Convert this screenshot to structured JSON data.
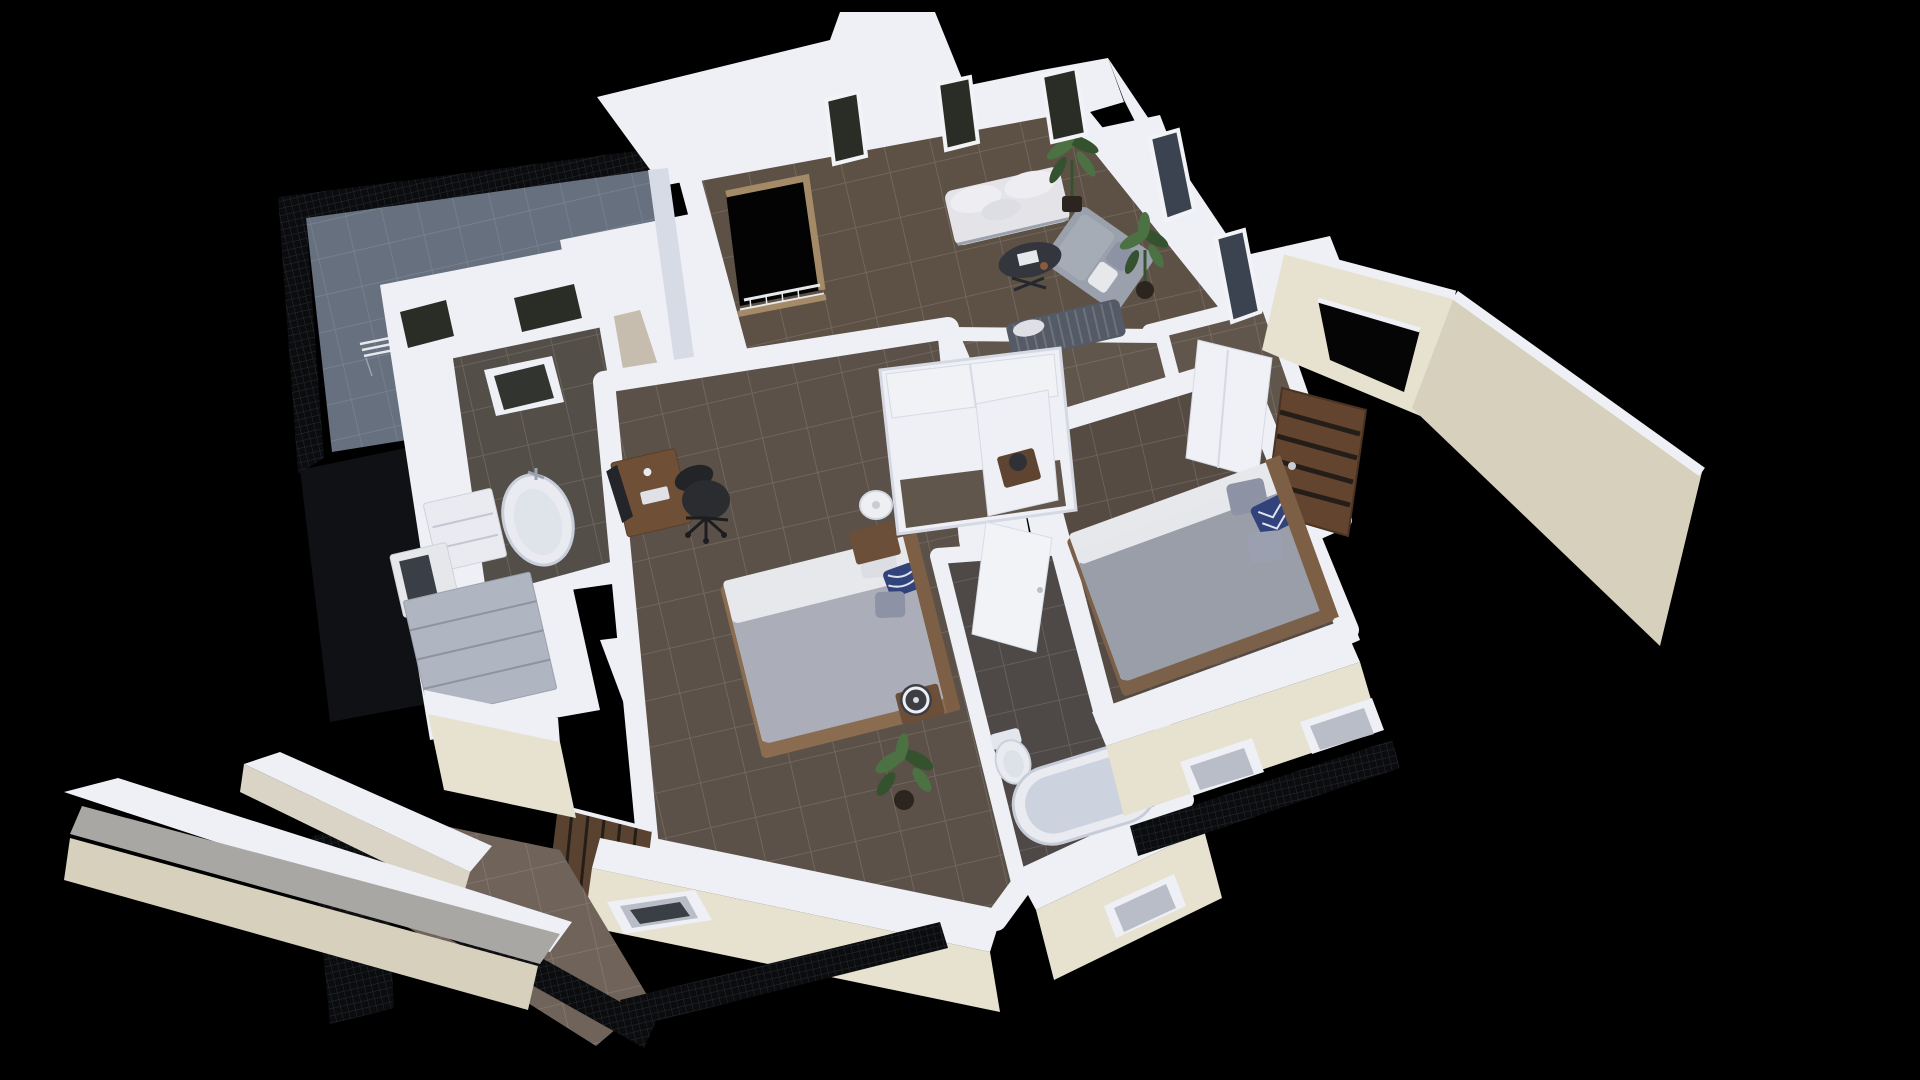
{
  "scene": {
    "title": "3D isometric cutaway floor plan render of an apartment on a black background",
    "background": "#000000",
    "colors": {
      "black": "#000000",
      "voidDark": "#101114",
      "wall": "#eef0f6",
      "wallShade": "#d7dbe5",
      "wallDark": "#bec4d1",
      "beige": "#e7e1d0",
      "beigeShade": "#d6d0bd",
      "grayTop": "#a8a7a3",
      "railing": "#0b0c0e",
      "railingLine": "#272a31",
      "terraceTile": "#66707e",
      "terraceGrout": "#7e8795",
      "floorLiving": "#5d5146",
      "floorBed1": "#5b5148",
      "floorBed2": "#554b43",
      "floorHall": "#60564c",
      "floorBath1": "#544e48",
      "floorBath2": "#4e4946",
      "floorPorch": "#6f635a",
      "groutLight": "#cfc9c2",
      "tan": "#c6bdae",
      "wood": "#a58a68",
      "woodDesk": "#6f5036",
      "doorWood": "#63452f",
      "doorSlat": "#241d18",
      "shutterWood": "#5a4230",
      "headboard": "#7c5f45",
      "bedBase": "#8a6c50",
      "bedBase2": "#7b604a",
      "duvet1": "#abaeb8",
      "duvet2": "#999ea9",
      "sheet": "#e7e8ec",
      "pillowWhite": "#dcdee4",
      "pillowNavy": "#32427a",
      "pillowGray": "#8d93a4",
      "sofaWhite": "#e4e4e8",
      "sofaGray": "#9aa1ac",
      "benchDark": "#545b66",
      "benchSlat": "#6d737d",
      "tableDark": "#33363c",
      "chairBlack": "#2b2c30",
      "monitor": "#23252a",
      "plant": "#4c7244",
      "plantDark": "#35522f",
      "pot": "#2c241e",
      "lamp": "#edeff3",
      "fixture": "#e9ebf1",
      "fixtureShade": "#ccd2de",
      "metal": "#9aa2b0",
      "glass": "#2a2d26",
      "glassBlue": "#3c4350",
      "glassGray": "#b8bdc7"
    },
    "terrace": {
      "label": "roof terrace",
      "furniture": [
        "bistro-table",
        "folding-chair",
        "folding-chair",
        "folding-bench"
      ]
    },
    "rooms": [
      {
        "id": "living-room",
        "label": "living room",
        "furniture": [
          "white-sofa",
          "gray-chaise-sofa",
          "slatted-bench-sofa",
          "coffee-table",
          "potted-plant",
          "potted-plant",
          "staircase-opening-with-railing"
        ]
      },
      {
        "id": "bathroom-1",
        "label": "bathroom with freestanding tub",
        "furniture": [
          "vanity-cabinet",
          "bathtub",
          "sink-cabinet",
          "wall-windows",
          "skylight-window"
        ]
      },
      {
        "id": "bedroom-1",
        "label": "bedroom with desk",
        "furniture": [
          "desk",
          "monitor",
          "office-chair",
          "double-bed",
          "nightstand",
          "table-lamp",
          "nightstand",
          "table-lamp",
          "potted-plant",
          "wardrobe",
          "wood-shutter-door"
        ]
      },
      {
        "id": "hallway",
        "label": "hallway and closets",
        "furniture": [
          "walk-in-closet",
          "white-door",
          "white-door",
          "sliding-closet-door",
          "front-door"
        ]
      },
      {
        "id": "bedroom-2",
        "label": "master bedroom",
        "furniture": [
          "double-bed",
          "patterned-pillows",
          "nightstand",
          "table-lamp"
        ]
      },
      {
        "id": "bathroom-2",
        "label": "bathroom with large tub",
        "furniture": [
          "toilet",
          "bathtub"
        ]
      }
    ],
    "exterior": {
      "features": [
        "terrace-mesh-railing",
        "entry-canopy",
        "boundary-wall",
        "south-facade-windows",
        "porch-tiles",
        "walkway-parapet",
        "balcony-railings"
      ]
    }
  }
}
